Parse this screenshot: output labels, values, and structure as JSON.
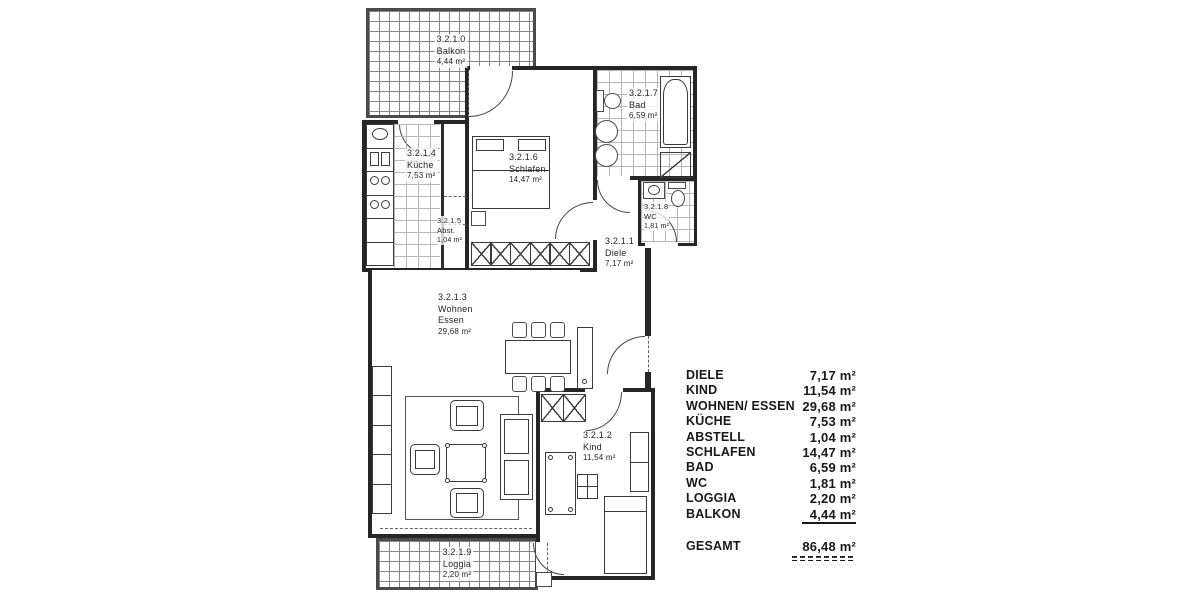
{
  "plan": {
    "rooms": {
      "balkon": {
        "id": "3.2.1.0",
        "name": "Balkon",
        "area": "4,44 m²"
      },
      "diele": {
        "id": "3.2.1.1",
        "name": "Diele",
        "area": "7,17 m²"
      },
      "kind": {
        "id": "3.2.1.2",
        "name": "Kind",
        "area": "11,54 m²"
      },
      "wohnen": {
        "id": "3.2.1.3",
        "name": "Wohnen",
        "name2": "Essen",
        "area": "29,68 m²"
      },
      "kueche": {
        "id": "3.2.1.4",
        "name": "Küche",
        "area": "7,53 m²"
      },
      "abstell": {
        "id": "3.2.1.5",
        "name": "Abst.",
        "area": "1,04 m²"
      },
      "schlafen": {
        "id": "3.2.1.6",
        "name": "Schlafen",
        "area": "14,47 m²"
      },
      "bad": {
        "id": "3.2.1.7",
        "name": "Bad",
        "area": "6,59 m²"
      },
      "wc": {
        "id": "3.2.1.8",
        "name": "WC",
        "area": "1,81 m²"
      },
      "loggia": {
        "id": "3.2.1.9",
        "name": "Loggia",
        "area": "2,20 m²"
      }
    }
  },
  "legend": {
    "rows": [
      {
        "name": "DIELE",
        "area": "7,17 m²"
      },
      {
        "name": "KIND",
        "area": "11,54 m²"
      },
      {
        "name": "WOHNEN/ ESSEN",
        "area": "29,68 m²"
      },
      {
        "name": "KÜCHE",
        "area": "7,53 m²"
      },
      {
        "name": "ABSTELL",
        "area": "1,04 m²"
      },
      {
        "name": "SCHLAFEN",
        "area": "14,47 m²"
      },
      {
        "name": "BAD",
        "area": "6,59 m²"
      },
      {
        "name": "WC",
        "area": "1,81 m²"
      },
      {
        "name": "LOGGIA",
        "area": "2,20 m²"
      },
      {
        "name": "BALKON",
        "area": "4,44 m²"
      }
    ],
    "total": {
      "name": "GESAMT",
      "area": "86,48 m²"
    }
  },
  "colors": {
    "ink": "#191919",
    "wall": "#262626"
  }
}
